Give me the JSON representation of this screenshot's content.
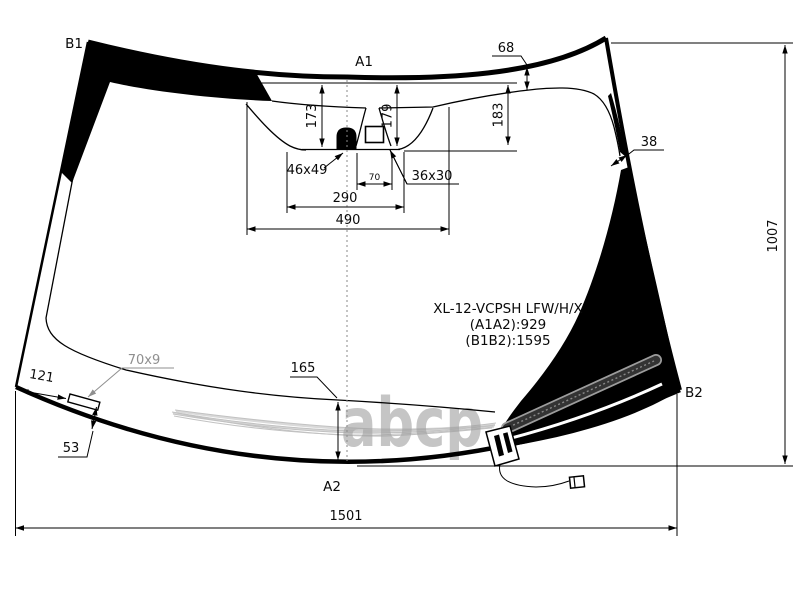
{
  "part_info": {
    "code": "XL-12-VCPSH LFW/H/X",
    "a1a2": "(A1A2):929",
    "b1b2": "(B1B2):1595"
  },
  "reference_points": {
    "b1": "B1",
    "a1": "A1",
    "b2": "B2",
    "a2": "A2"
  },
  "dimensions": {
    "frit_band_top": "68",
    "frit_band_side": "38",
    "sensor_drop_left": "173",
    "sensor_drop_center": "179",
    "sensor_drop_right": "183",
    "camera_window_width": "70",
    "sensor_area_width": "290",
    "sensor_area_full_width": "490",
    "glass_height": "1007",
    "glass_width_bottom": "1501",
    "lower_band_height": "165",
    "corner_edge_length": "121",
    "corner_inset": "53"
  },
  "components": {
    "rain_sensor": "46x49",
    "camera_window": "36x30",
    "corner_bracket": "70x9"
  },
  "watermark": "abcp",
  "colors": {
    "line": "#000000",
    "background": "#ffffff",
    "watermark": "#a0a0a0",
    "wiper_hatch": "#c2c2c2",
    "molding": "#3a3a3a"
  }
}
